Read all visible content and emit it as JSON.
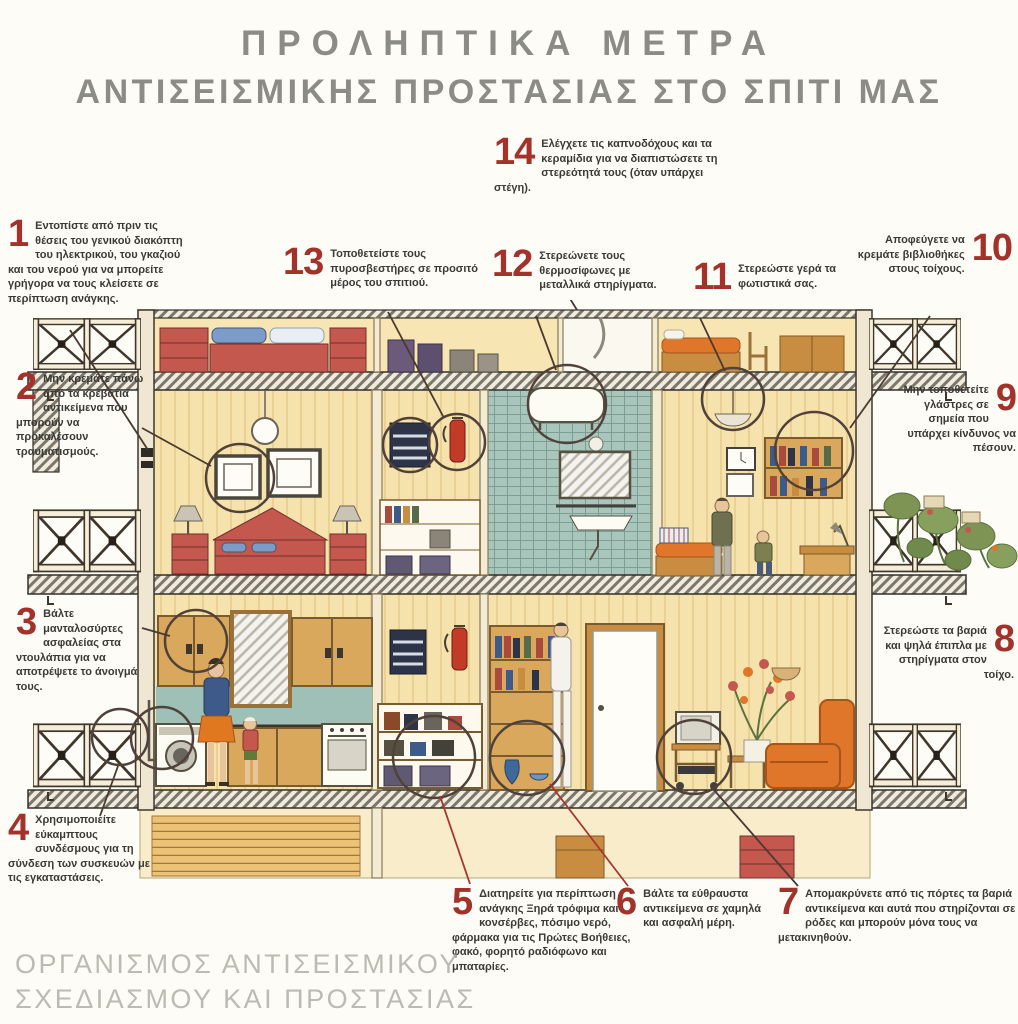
{
  "title": {
    "line1": "ΠΡΟΛΗΠΤΙΚΑ ΜΕΤΡΑ",
    "line2": "ΑΝΤΙΣΕΙΣΜΙΚΗΣ ΠΡΟΣΤΑΣΙΑΣ ΣΤΟ ΣΠΙΤΙ ΜΑΣ"
  },
  "footer": {
    "line1": "ΟΡΓΑΝΙΣΜΟΣ ΑΝΤΙΣΕΙΣΜΙΚΟΥ",
    "line2": "ΣΧΕΔΙΑΣΜΟΥ ΚΑΙ ΠΡΟΣΤΑΣΙΑΣ"
  },
  "colors": {
    "number_red": "#a2322a",
    "title_gray": "#8c8c86",
    "footer_gray": "#bbbbb4",
    "body_text": "#3c3a36",
    "wall_wheat": "#f6e2ac",
    "tile_teal": "#a9c6bd",
    "furniture_red": "#c4584f",
    "accent_orange": "#e0762a"
  },
  "tips": [
    {
      "number": "1",
      "text": "Εντοπίστε από πριν τις θέσεις του γενικού διακόπτη του ηλεκτρικού, του γκαζιού και του νερού για να μπορείτε γρήγορα να τους κλείσετε σε περίπτωση ανάγκης."
    },
    {
      "number": "2",
      "text": "Μην κρεμάτε πάνω από τα κρεβάτια αντικείμενα που μπορούν να προκαλέσουν τραυματισμούς."
    },
    {
      "number": "3",
      "text": "Βάλτε μανταλοσύρτες ασφαλείας στα ντουλάπια για να αποτρέψετε το άνοιγμά τους."
    },
    {
      "number": "4",
      "text": "Χρησιμοποιείτε εύκαμπτους συνδέσμους για τη σύνδεση των συσκευών με τις εγκαταστάσεις."
    },
    {
      "number": "5",
      "text": "Διατηρείτε για περίπτωση ανάγκης Ξηρά τρόφιμα και κονσέρβες, πόσιμο νερό, φάρμακα για τις Πρώτες Βοήθειες, φακό, φορητό ραδιόφωνο και μπαταρίες."
    },
    {
      "number": "6",
      "text": "Βάλτε τα εύθραυστα αντικείμενα σε χαμηλά και ασφαλή μέρη."
    },
    {
      "number": "7",
      "text": "Απομακρύνετε από τις πόρτες τα βαριά αντικείμενα και αυτά που στηρίζονται σε ρόδες και μπορούν μόνα τους να μετακινηθούν."
    },
    {
      "number": "8",
      "text": "Στερεώστε τα βαριά και ψηλά έπιπλα με στηρίγματα στον τοίχο."
    },
    {
      "number": "9",
      "text": "Μην τοποθετείτε γλάστρες σε σημεία που υπάρχει κίνδυνος να πέσουν."
    },
    {
      "number": "10",
      "text": "Αποφεύγετε να κρεμάτε βιβλιοθήκες στους τοίχους."
    },
    {
      "number": "11",
      "text": "Στερεώστε γερά τα φωτιστικά σας."
    },
    {
      "number": "12",
      "text": "Στερεώνετε τους θερμοσίφωνες με μεταλλικά στηρίγματα."
    },
    {
      "number": "13",
      "text": "Τοποθετείστε τους πυροσβεστήρες σε προσιτό μέρος του σπιτιού."
    },
    {
      "number": "14",
      "text": "Ελέγχετε τις καπνοδόχους και τα κεραμίδια για να διαπιστώσετε τη στερεότητά τους (όταν υπάρχει στέγη)."
    }
  ]
}
